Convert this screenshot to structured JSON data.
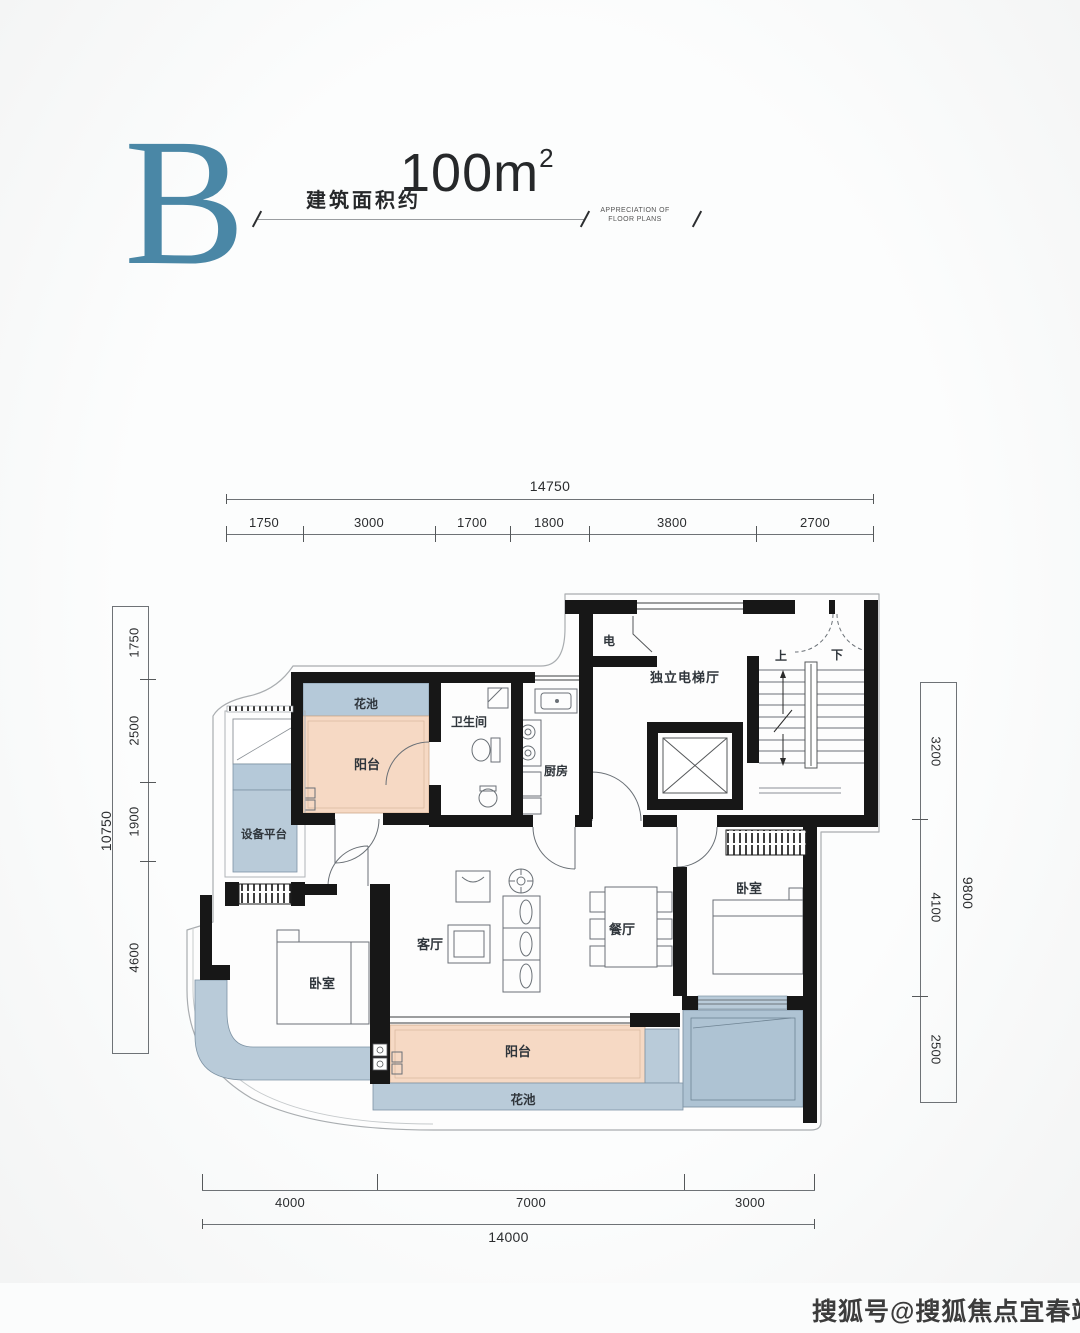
{
  "header": {
    "unit_letter": "B",
    "area_prefix": "建筑面积约",
    "area_number": "100",
    "area_unit": "m",
    "area_exponent": "2",
    "tagline_line1": "APPRECIATION OF",
    "tagline_line2": "FLOOR PLANS"
  },
  "dimensions": {
    "top": {
      "total": "14750",
      "segments": [
        "1750",
        "3000",
        "1700",
        "1800",
        "3800",
        "2700"
      ]
    },
    "left": {
      "total": "10750",
      "segments": [
        "1750",
        "2500",
        "1900",
        "4600"
      ]
    },
    "right": {
      "total": "9800",
      "segments": [
        "3200",
        "4100",
        "2500"
      ]
    },
    "bottom": {
      "total": "14000",
      "segments": [
        "4000",
        "7000",
        "3000"
      ]
    }
  },
  "rooms": {
    "electrical": "电",
    "elevator_hall": "独立电梯厅",
    "stair_up": "上",
    "stair_down": "下",
    "flower_bed_top": "花池",
    "balcony_top": "阳台",
    "bathroom": "卫生间",
    "kitchen": "厨房",
    "equipment_platform": "设备平台",
    "bedroom_left": "卧室",
    "living_room": "客厅",
    "dining_room": "餐厅",
    "bedroom_right": "卧室",
    "balcony_bottom": "阳台",
    "flower_bed_bottom": "花池"
  },
  "watermark": "搜狐号@搜狐焦点宜春站",
  "colors": {
    "accent": "#4a87a6",
    "fill_blue": "#b9cbd9",
    "fill_peach": "#f6d9c4",
    "wall": "#171717"
  }
}
